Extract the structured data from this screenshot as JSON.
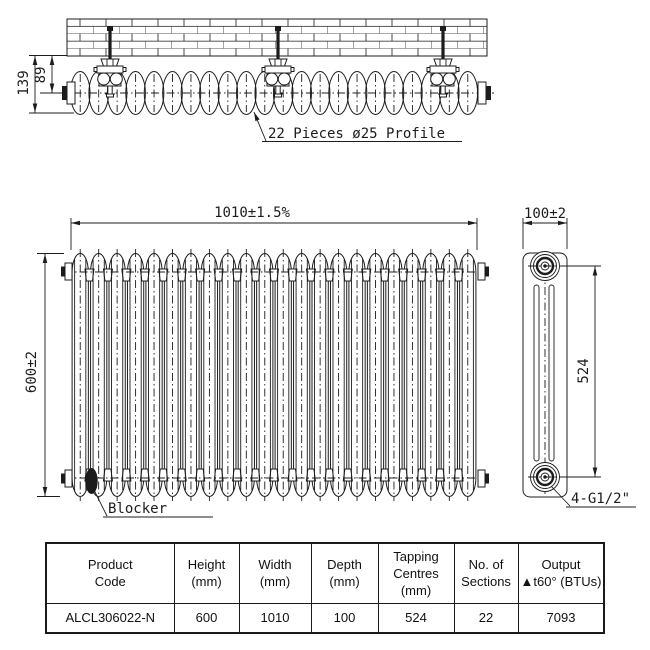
{
  "title": "radiator-technical-drawing",
  "sections_count": 22,
  "top_view": {
    "annotation": "22 Pieces ø25 Profile",
    "dim_wall_to_front": "139",
    "dim_wall_to_centre": "89"
  },
  "front_view": {
    "dim_width": "1010±1.5%",
    "dim_height": "600±2",
    "blocker_label": "Blocker"
  },
  "side_view": {
    "dim_depth": "100±2",
    "dim_tapping_centres": "524",
    "connection_label": "4-G1/2\""
  },
  "table": {
    "headers": [
      [
        "Product",
        "Code"
      ],
      [
        "Height",
        "(mm)"
      ],
      [
        "Width",
        "(mm)"
      ],
      [
        "Depth",
        "(mm)"
      ],
      [
        "Tapping",
        "Centres",
        "(mm)"
      ],
      [
        "No. of",
        "Sections"
      ],
      [
        "Output",
        "▲t60° (BTUs)"
      ]
    ],
    "row": [
      "ALCL306022-N",
      "600",
      "1010",
      "100",
      "524",
      "22",
      "7093"
    ]
  },
  "colors": {
    "line": "#1c1c1c",
    "background": "#ffffff"
  }
}
